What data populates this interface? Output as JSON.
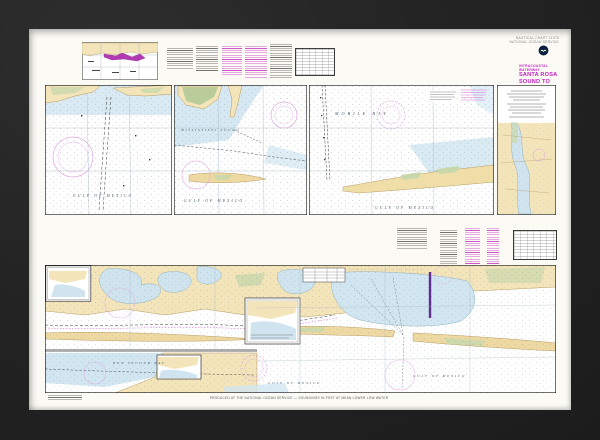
{
  "palette": {
    "frame": "#232323",
    "paper": "#fbfaf5",
    "land_tan": "#f3e4ba",
    "marsh_green": "#c9d8ab",
    "shallow_blue": "#d2e6f1",
    "magenta_accent": "#c21ec2",
    "compass_magenta": "#dfa8df",
    "route_purple": "#5e2f8f",
    "sea_label_color": "#42596a"
  },
  "header": {
    "catalog_line1": "NAUTICAL CHART 11378",
    "catalog_line2": "NATIONAL OCEAN SERVICE",
    "noaa_logo": "noaa-emblem-icon",
    "series_label": "INTRACOASTAL WATERWAY",
    "title_line1": "SANTA ROSA",
    "title_line2": "SOUND TO",
    "title_line3": "DAUPHIN ISLAND"
  },
  "map_labels": {
    "mississippi_sound": "MISSISSIPPI SOUND",
    "mobile_bay": "MOBILE BAY",
    "bon_secour_bay": "BON SECOUR BAY",
    "gulf_of_mexico": "GULF OF MEXICO"
  },
  "footer": {
    "production_note": "PRODUCED AT THE NATIONAL OCEAN SERVICE — SOUNDINGS IN FEET AT MEAN LOWER LOW WATER"
  }
}
